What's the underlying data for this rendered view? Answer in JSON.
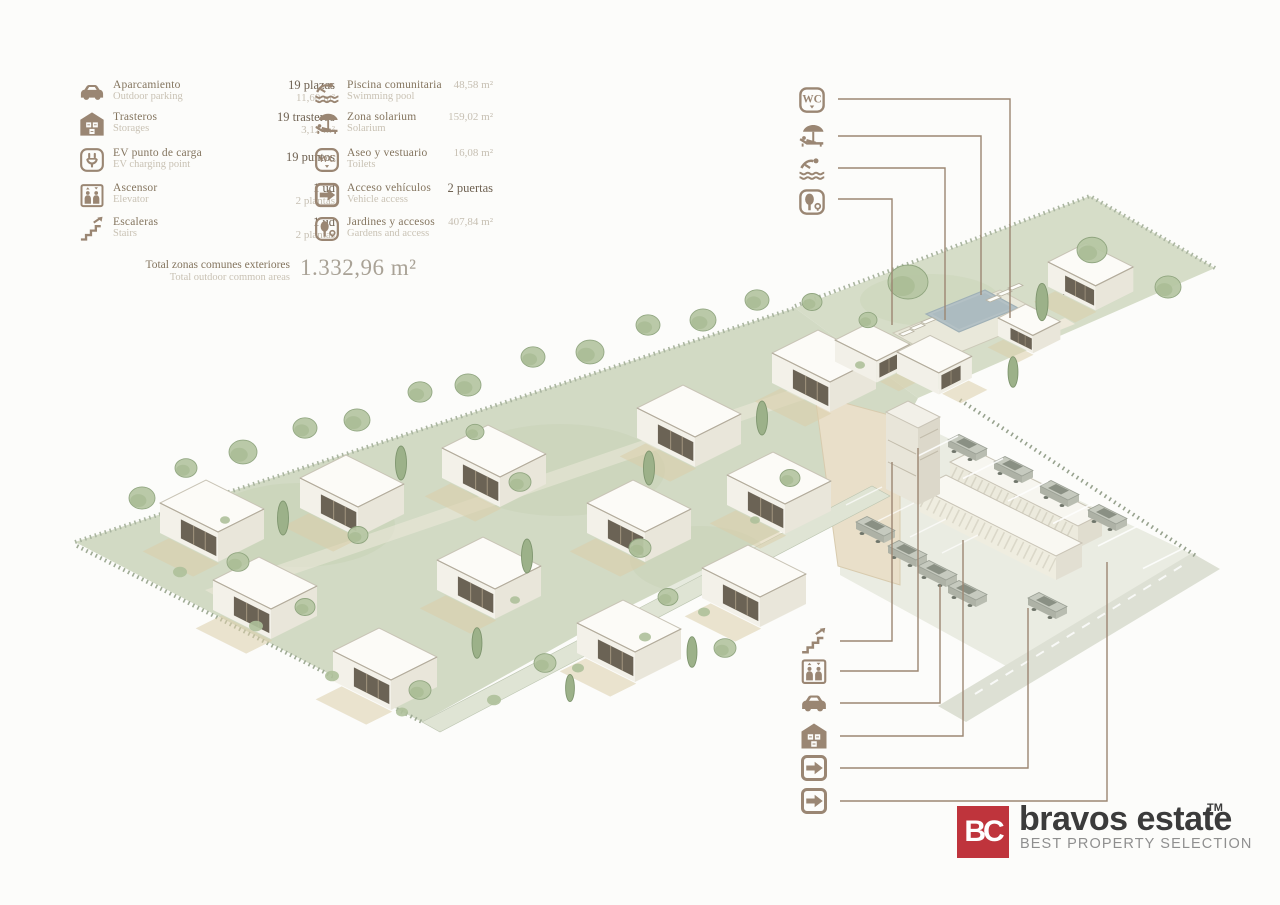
{
  "palette": {
    "icon_brown": "#9a8673",
    "callout_line": "#9c8672",
    "logo_red": "#bf343c",
    "ground_green": "#d2dac4",
    "tree_green": "#b7c7a4",
    "pool_blue": "#b4c1c5",
    "house_white": "#fcfbf7"
  },
  "legend": {
    "col1": [
      {
        "icon": "parking-icon",
        "label": "Aparcamiento",
        "sublabel": "Outdoor parking",
        "value": "19 plazas",
        "subvalue": "11,60 m²"
      },
      {
        "icon": "storage-icon",
        "label": "Trasteros",
        "sublabel": "Storages",
        "value": "19 trasteros",
        "subvalue": "3,12 m²"
      },
      {
        "icon": "ev-charging-icon",
        "label": "EV punto de carga",
        "sublabel": "EV charging point",
        "value": "19 puntos",
        "subvalue": ""
      },
      {
        "icon": "elevator-icon",
        "label": "Ascensor",
        "sublabel": "Elevator",
        "value": "1 ud",
        "subvalue": "2 plantas"
      },
      {
        "icon": "stairs-icon",
        "label": "Escaleras",
        "sublabel": "Stairs",
        "value": "1 ud",
        "subvalue": "2 plantas"
      }
    ],
    "col2": [
      {
        "icon": "pool-icon",
        "label": "Piscina comunitaria",
        "sublabel": "Swimming pool",
        "value": "48,58 m²"
      },
      {
        "icon": "solarium-icon",
        "label": "Zona solarium",
        "sublabel": "Solarium",
        "value": "159,02 m²"
      },
      {
        "icon": "wc-icon",
        "label": "Aseo y vestuario",
        "sublabel": "Toilets",
        "value": "16,08 m²"
      },
      {
        "icon": "vehicle-access-icon",
        "label": "Acceso vehículos",
        "sublabel": "Vehicle access",
        "value": "2 puertas"
      },
      {
        "icon": "gardens-icon",
        "label": "Jardines y accesos",
        "sublabel": "Gardens and access",
        "value": "407,84 m²"
      }
    ],
    "total": {
      "label": "Total zonas comunes exteriores",
      "sublabel": "Total outdoor common areas",
      "value": "1.332,96 m²"
    }
  },
  "callouts": {
    "top": [
      "toilets",
      "solarium",
      "swimming-pool",
      "gardens"
    ],
    "bottom": [
      "stairs",
      "elevator",
      "parking",
      "storages",
      "vehicle-access-1",
      "vehicle-access-2"
    ]
  },
  "logo": {
    "monogram": "BC",
    "name": "bravos estate",
    "trademark": "TM",
    "tagline": "BEST PROPERTY SELECTION"
  }
}
